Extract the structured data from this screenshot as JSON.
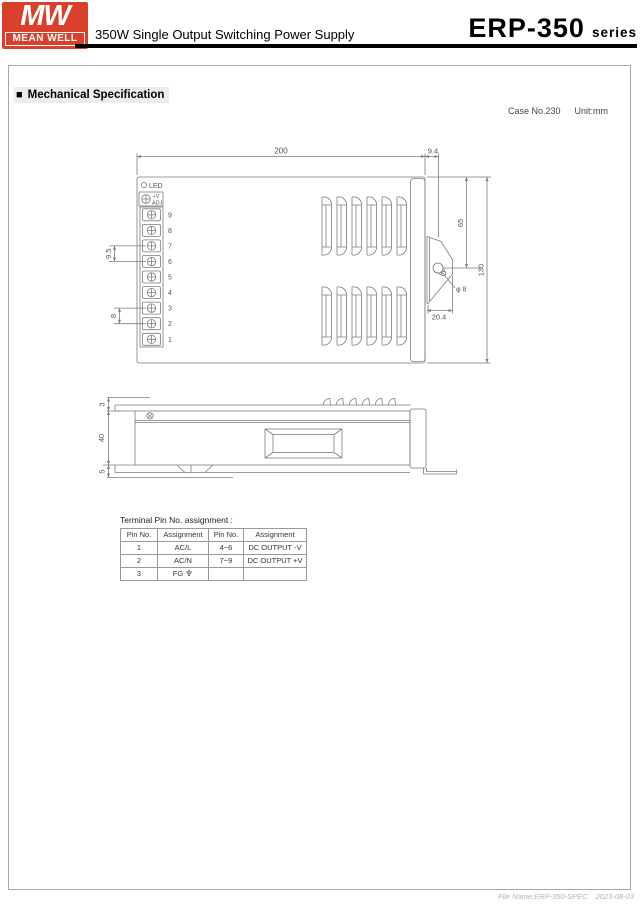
{
  "header": {
    "logo_mw": "MW",
    "logo_brand": "MEAN WELL",
    "doc_title": "350W Single Output Switching Power Supply",
    "series_name": "ERP-350",
    "series_suffix": "series"
  },
  "section": {
    "bullet": "■",
    "title": "Mechanical Specification"
  },
  "meta": {
    "case_no": "Case No.230",
    "unit": "Unit:mm"
  },
  "drawing": {
    "led_label": "LED",
    "adj_line1": "+V",
    "adj_line2": "ADJ",
    "pin_numbers": [
      "9",
      "8",
      "7",
      "6",
      "5",
      "4",
      "3",
      "2",
      "1"
    ],
    "dims": {
      "width": "200",
      "bracket_offset": "9.4",
      "hole_to_top": "65",
      "height": "130",
      "hole_dia": "φ 8",
      "bracket_width": "20.4",
      "pin_pitch_dc": "9.5",
      "pin_pitch_ac": "8",
      "cover_lip": "3",
      "body_height": "40",
      "foot_height": "5"
    }
  },
  "pin_table": {
    "title": "Terminal Pin No. assignment :",
    "headers": [
      "Pin No.",
      "Assignment",
      "Pin No.",
      "Assignment"
    ],
    "rows": [
      [
        "1",
        "AC/L",
        "4~6",
        "DC OUTPUT -V"
      ],
      [
        "2",
        "AC/N",
        "7~9",
        "DC OUTPUT +V"
      ],
      [
        "3",
        "FG",
        "",
        ""
      ]
    ]
  },
  "footer": {
    "file_name": "File Name:ERP-350-SPEC",
    "date": "2023-08-03"
  }
}
